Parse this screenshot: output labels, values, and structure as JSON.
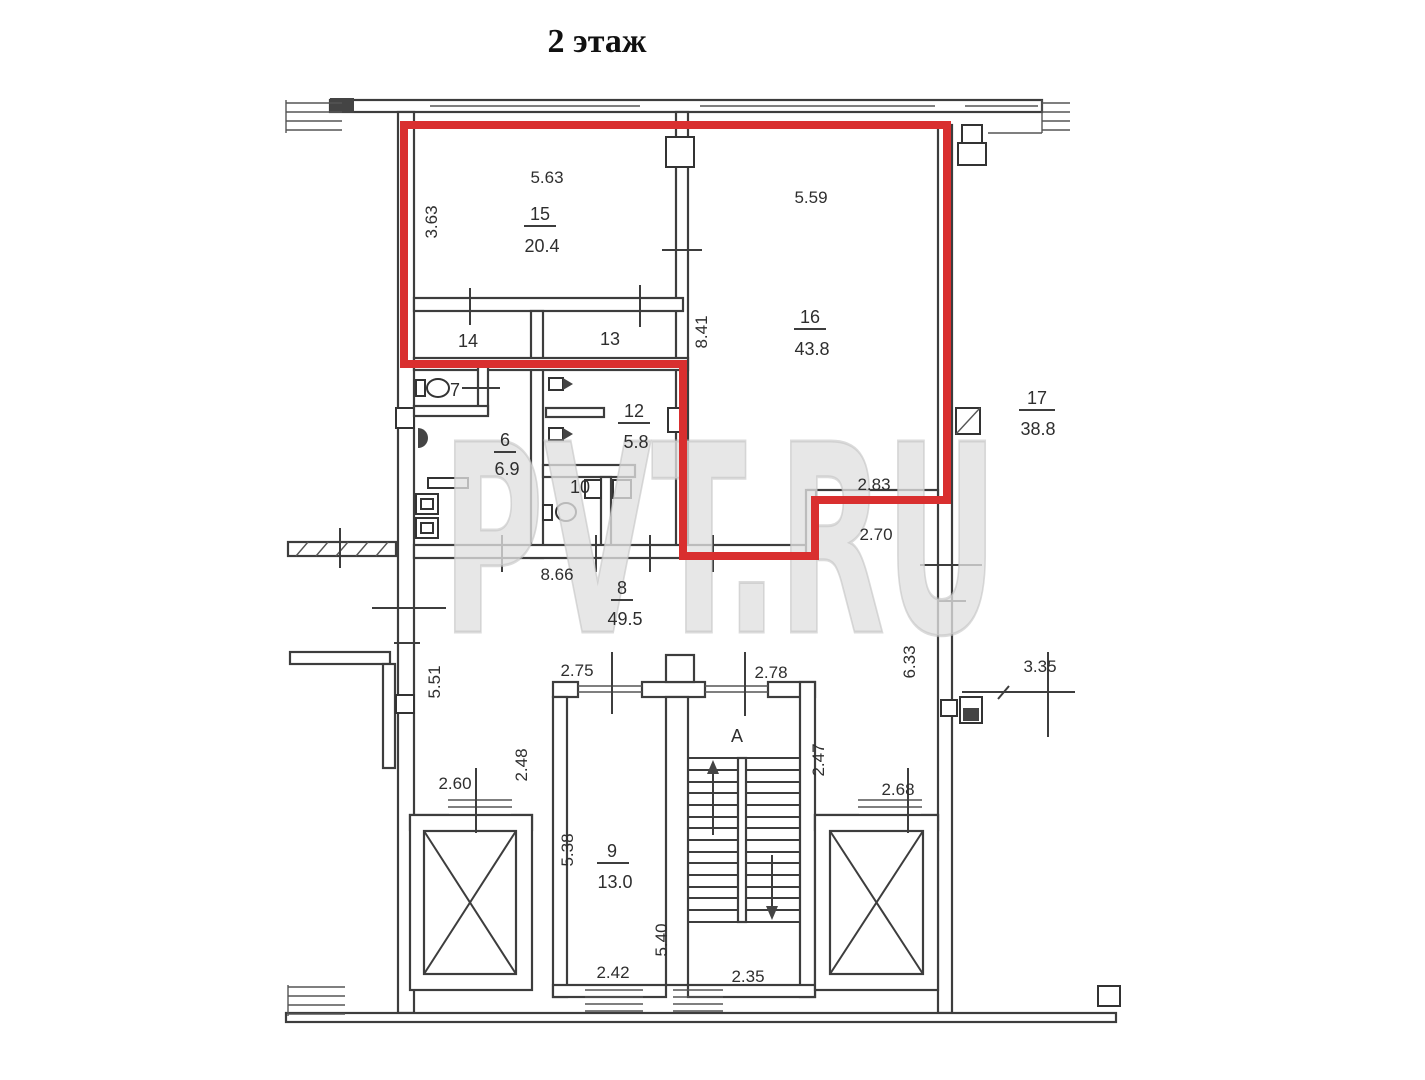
{
  "header": {
    "title": "2 этаж"
  },
  "watermark": {
    "text": "PVT.RU",
    "color": "#dcdcdc"
  },
  "colors": {
    "highlight": "#d92f2f",
    "walls": "#3d3d3d",
    "text": "#2e2e2e"
  },
  "stairs": {
    "label": "А"
  },
  "rooms": {
    "r15": {
      "number": "15",
      "area": "20.4"
    },
    "r16": {
      "number": "16",
      "area": "43.8"
    },
    "r17": {
      "number": "17",
      "area": "38.8"
    },
    "r14": {
      "number": "14"
    },
    "r13": {
      "number": "13"
    },
    "r12": {
      "number": "12",
      "area": "5.8"
    },
    "r7": {
      "number": "7"
    },
    "r6": {
      "number": "6",
      "area": "6.9"
    },
    "r10": {
      "number": "10"
    },
    "r8": {
      "number": "8",
      "area": "49.5"
    },
    "r9": {
      "number": "9",
      "area": "13.0"
    }
  },
  "dims": {
    "d563": "5.63",
    "d363": "3.63",
    "d559": "5.59",
    "d841": "8.41",
    "d283": "2.83",
    "d270": "2.70",
    "d866": "8.66",
    "d551": "5.51",
    "d633": "6.33",
    "d335": "3.35",
    "d275": "2.75",
    "d278": "2.78",
    "d248": "2.48",
    "d247": "2.47",
    "d260": "2.60",
    "d268": "2.68",
    "d538": "5.38",
    "d540": "5.40",
    "d242": "2.42",
    "d235": "2.35"
  }
}
